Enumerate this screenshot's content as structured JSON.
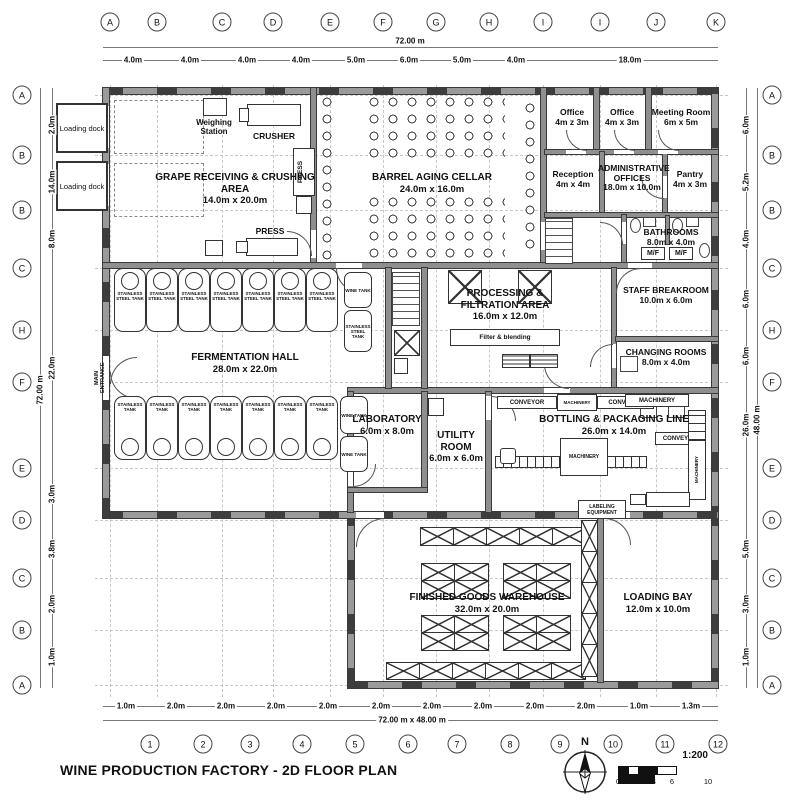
{
  "title": "WINE PRODUCTION FACTORY - 2D FLOOR PLAN",
  "scale_bar": {
    "label": "1:200",
    "north": "N",
    "ticks": [
      "0",
      "1",
      "2",
      "4",
      "6",
      "10"
    ]
  },
  "grid": {
    "top": {
      "letters": [
        "A",
        "B",
        "C",
        "D",
        "E",
        "F",
        "G",
        "H",
        "I",
        "I",
        "J",
        "K"
      ],
      "dims": [
        "4.0m",
        "4.0m",
        "4.0m",
        "4.0m",
        "5.0m",
        "6.0m",
        "5.0m",
        "4.0m",
        "18.0m"
      ],
      "overall": "72.00 m"
    },
    "bottom": {
      "numbers": [
        "1",
        "2",
        "3",
        "4",
        "5",
        "6",
        "7",
        "8",
        "9",
        "10",
        "11",
        "12"
      ],
      "dims": [
        "1.0m",
        "2.0m",
        "2.0m",
        "2.0m",
        "2.0m",
        "2.0m",
        "2.0m",
        "2.0m",
        "2.0m",
        "2.0m",
        "1.0m",
        "1.3m"
      ],
      "overall": "72.00 m x 48.00 m"
    },
    "left": {
      "letters": [
        "A",
        "B",
        "B",
        "C",
        "H",
        "F",
        "E",
        "D",
        "C",
        "B",
        "A"
      ],
      "dims": [
        "2.0m",
        "14.0m",
        "8.0m",
        "22.0m",
        "3.0m",
        "3.8m",
        "2.0m",
        "1.0m"
      ],
      "overall": "72.00 m"
    },
    "right": {
      "letters": [
        "A",
        "B",
        "B",
        "C",
        "H",
        "F",
        "E",
        "D",
        "C",
        "B",
        "A"
      ],
      "dims": [
        "6.0m",
        "5.2m",
        "4.0m",
        "6.0m",
        "6.0m",
        "26.0m",
        "5.0m",
        "3.0m",
        "1.0m"
      ],
      "overall": "48.00 m"
    }
  },
  "rooms": {
    "grape": {
      "name": "GRAPE RECEIVING & CRUSHING AREA",
      "dims": "14.0m x 20.0m"
    },
    "cellar": {
      "name": "BARREL AGING CELLAR",
      "dims": "24.0m x 16.0m"
    },
    "office1": {
      "name": "Office",
      "dims": "4m z 3m"
    },
    "office2": {
      "name": "Office",
      "dims": "4m x 3m"
    },
    "meeting": {
      "name": "Meeting Room",
      "dims": "6m x 5m"
    },
    "reception": {
      "name": "Reception",
      "dims": "4m x 4m"
    },
    "admin": {
      "name": "ADMINISTRATIVE OFFICES",
      "dims": "18.0m x 10.0m"
    },
    "pantry": {
      "name": "Pantry",
      "dims": "4m x 3m"
    },
    "bathrooms": {
      "name": "BATHROOMS",
      "dims": "8.0m x 4.0m",
      "mf": "M/F"
    },
    "breakroom": {
      "name": "STAFF BREAKROOM",
      "dims": "10.0m x 6.0m"
    },
    "changing": {
      "name": "CHANGING ROOMS",
      "dims": "8.0m x 4.0m"
    },
    "processing": {
      "name": "PROCESSING & FILTRATION AREA",
      "dims": "16.0m x 12.0m",
      "filter": "Filter & blending"
    },
    "fermentation": {
      "name": "FERMENTATION HALL",
      "dims": "28.0m x 22.0m"
    },
    "laboratory": {
      "name": "LABORATORY",
      "dims": "6.0m x 8.0m"
    },
    "utility": {
      "name": "UTILITY ROOM",
      "dims": "6.0m x 6.0m"
    },
    "bottling": {
      "name": "BOTTLING & PACKAGING LINE",
      "dims": "26.0m x 14.0m"
    },
    "warehouse": {
      "name": "FINISHED GOODS WAREHOUSE",
      "dims": "32.0m x 20.0m"
    },
    "loading_bay": {
      "name": "LOADING BAY",
      "dims": "12.0m x 10.0m"
    }
  },
  "equipment": {
    "weighing": "Weighing Station",
    "crusher": "CRUSHER",
    "press": "PRESS",
    "loading_dock": "Loading dock",
    "main_entrance": "MAIN ENTRANCE",
    "conveyor": "CONVEYOR",
    "machinery": "MACHINERY",
    "labeling": "LABELING EQUIPMENT",
    "tank_steel": "STAINLESS STEEL TANK",
    "tank_plain": "STAINLESS TANK",
    "wine_tank": "WINE TANK"
  }
}
